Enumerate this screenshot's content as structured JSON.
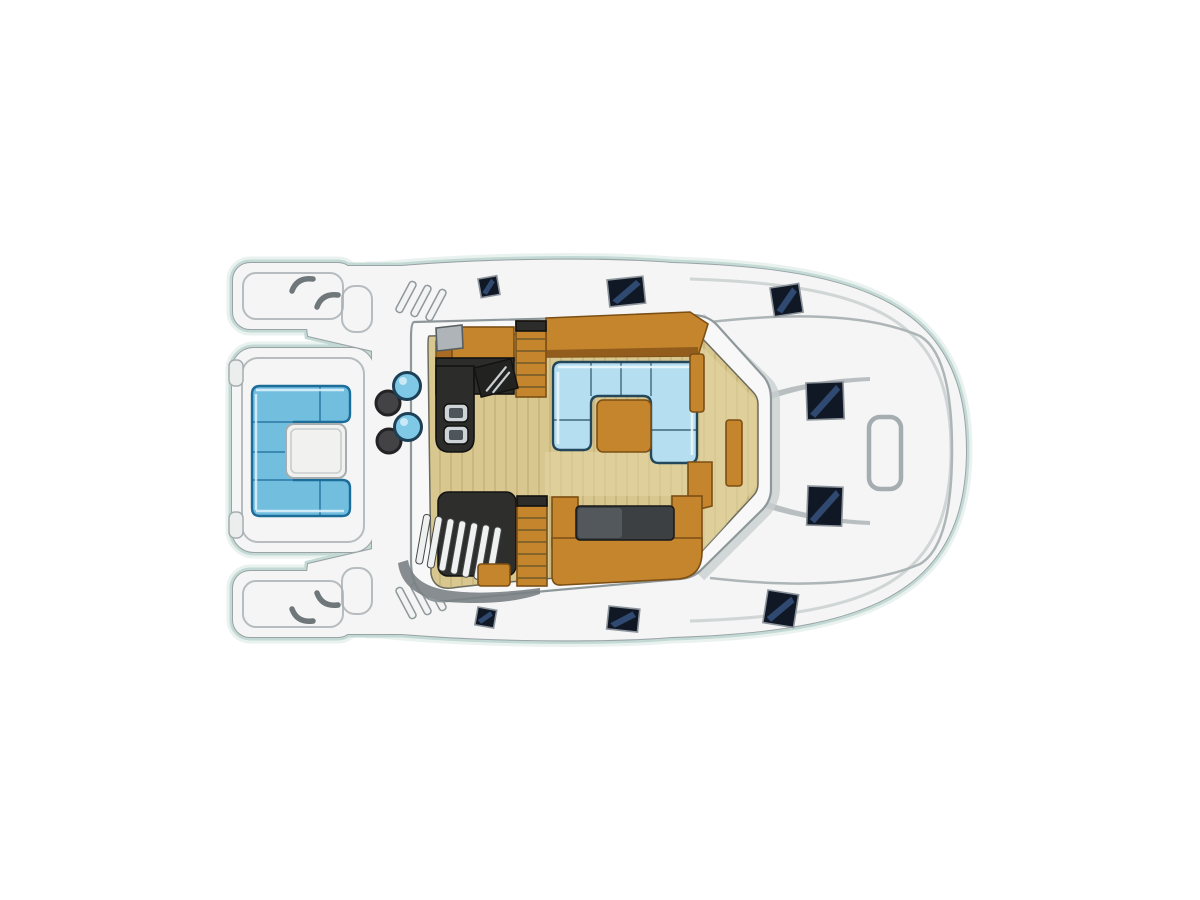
{
  "diagram": {
    "type": "yacht-deck-floor-plan",
    "view": "top-down",
    "parts": [
      "port-bow-pontoon",
      "starboard-bow-pontoon",
      "bow-seating-u-sofa",
      "bow-table",
      "foredeck",
      "foredeck-stools",
      "side-walkways",
      "salon",
      "galley-counter",
      "galley-sinks",
      "galley-cooktop",
      "companionway-steps",
      "salon-u-sofa",
      "salon-coffee-table",
      "aft-bench",
      "spiral-staircase",
      "wood-steps",
      "aft-deck",
      "deck-hatches",
      "transom-handle"
    ],
    "counts": {
      "deck_hatches": 8,
      "foredeck_blue_stools": 2,
      "foredeck_dark_stools": 2,
      "sinks": 2
    }
  },
  "colors": {
    "page_bg": "#ffffff",
    "hull_halo": "#c3d9d4",
    "hull_fill": "#f4f5f4",
    "hull_line": "#9aa3a6",
    "seam": "#aab2b5",
    "seam_soft": "#c7cdcd",
    "deck_curve": "#aeb5b7",
    "cleat": "#6f777a",
    "ridge_fill": "#f2f3f2",
    "ridge_line": "#8f989b",
    "handle_line": "#a6adb0",
    "tab_fill": "#eceeee",
    "wall_shadow": "#c9cfd0",
    "wall_fill": "#f7f8f7",
    "wall_line": "#8e979a",
    "floor": "#d8c78e",
    "floor_edge": "#6b6b5f",
    "floor_light": "#e6daa8",
    "plank": "#a6915a",
    "wood": "#c5852d",
    "wood_line": "#7c4f15",
    "wood_dark": "#a96b24",
    "wood_shade": "#915c1c",
    "tread": "#6f5a2a",
    "counter": "#2c2c2a",
    "counter_edge": "#121210",
    "cooktop": "#222220",
    "utensil": "#c9ced1",
    "sink_rim": "#cdd3d6",
    "sink_basin": "#4e565c",
    "tv_fill": "#aeb4b7",
    "tv_line": "#565e61",
    "sofa": "#b5def0",
    "sofa_line": "#25475c",
    "sofa_hi": "#eaf6fb",
    "bow_sofa": "#72bedf",
    "bow_sofa_line": "#1d6d9a",
    "bow_sofa_hi": "#d8f0fa",
    "table_white": "#f1f1ef",
    "cushion": "#3c4043",
    "cushion_edge": "#17181a",
    "cushion_hi": "#555b60",
    "stairwell": "#2e2e2c",
    "step_fill": "#eff0f0",
    "step_line": "#44464a",
    "crescent": "#7a8184",
    "hatch": "#101826",
    "hatch_edge": "#8d949c",
    "hatch_streak": "#3a5a8a",
    "stool_blue": "#7fc8e6",
    "stool_blue_line": "#1e4057",
    "stool_blue_hi": "#d6eef8",
    "stool_dark": "#434346",
    "stool_dark_line": "#232326"
  }
}
